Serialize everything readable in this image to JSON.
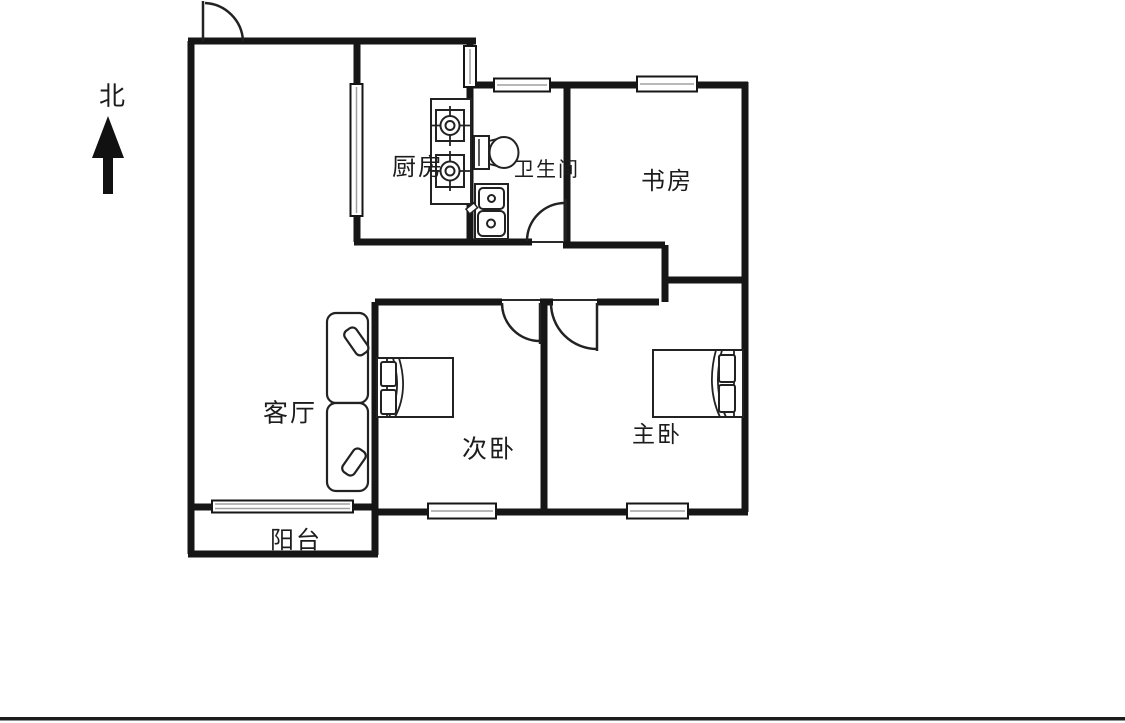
{
  "compass": {
    "label": "北"
  },
  "rooms": {
    "kitchen": {
      "label": "厨房"
    },
    "bathroom": {
      "label": "卫生间"
    },
    "study": {
      "label": "书房"
    },
    "living_room": {
      "label": "客厅"
    },
    "secondary_bedroom": {
      "label": "次卧"
    },
    "master_bedroom": {
      "label": "主卧"
    },
    "balcony": {
      "label": "阳台"
    }
  },
  "colors": {
    "wall": "#161616",
    "thin_line": "#2a2a2a",
    "window_inner": "#a0a0a0",
    "background": "#ffffff",
    "bottom_border": "#1c1c1c"
  }
}
